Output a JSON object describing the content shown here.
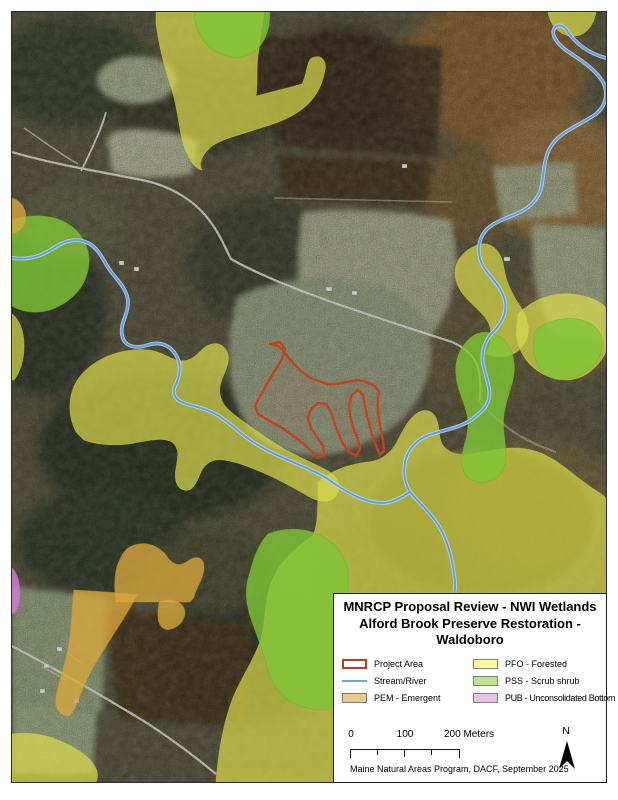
{
  "map_title": {
    "full": "MNRCP Proposal Review - NWI Wetlands Alford Brook Preserve Restoration - Waldoboro",
    "lines": [
      "MNRCP Proposal Review - NWI Wetlands",
      "Alford Brook Preserve Restoration -",
      "Waldoboro"
    ]
  },
  "legend": {
    "items": [
      {
        "label": "Project Area",
        "type": "outline",
        "color": "#c0391b"
      },
      {
        "label": "Stream/River",
        "type": "line",
        "color": "#6ba3e0"
      },
      {
        "label": "PEM - Emergent",
        "type": "fill",
        "color": "#ecca8b"
      },
      {
        "label": "PFO - Forested",
        "type": "fill",
        "color": "#f9f9a2"
      },
      {
        "label": "PSS - Scrub shrub",
        "type": "fill",
        "color": "#bde295"
      },
      {
        "label": "PUB - Unconsolidated Bottom",
        "type": "fill",
        "color": "#e7c3e7"
      }
    ]
  },
  "scale_bar": {
    "label_0": "0",
    "label_100": "100",
    "label_200": "200 Meters"
  },
  "north_arrow_label": "N",
  "credits": "Maine Natural Areas Program, DACF, September 2025"
}
